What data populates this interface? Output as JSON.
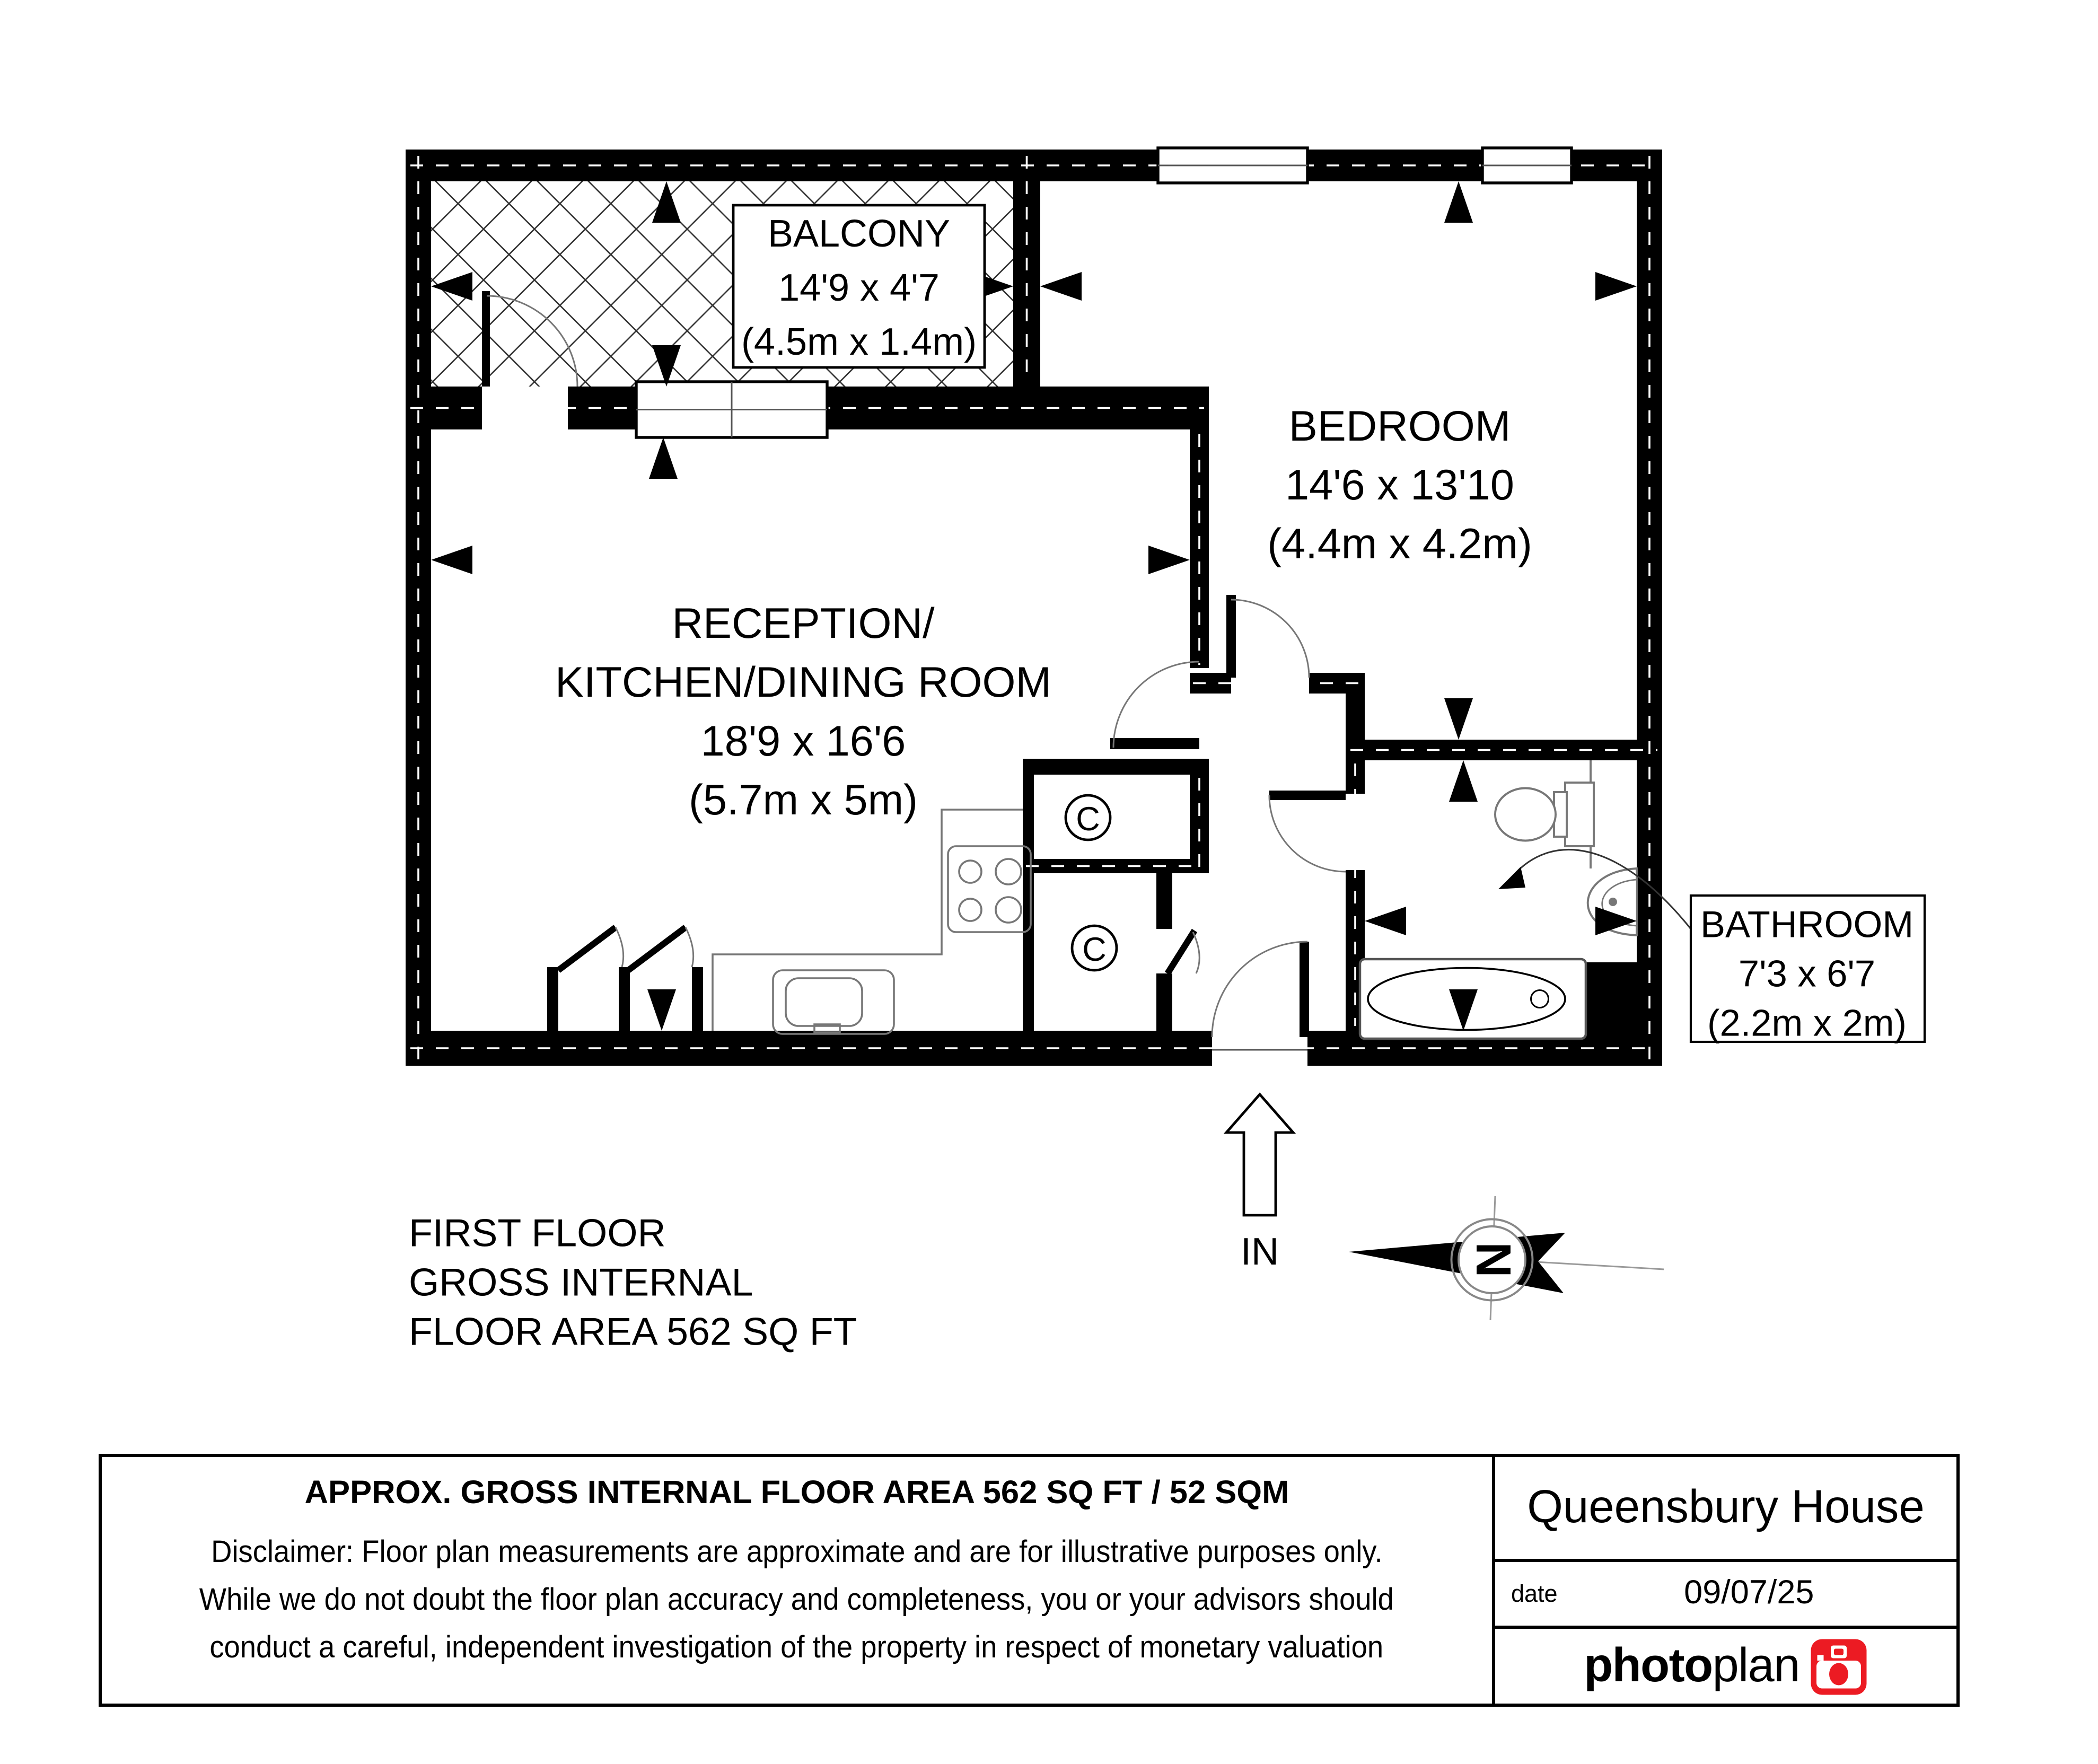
{
  "floor_plan": {
    "rooms": [
      {
        "name": "BALCONY",
        "dims": "14'9 x 4'7",
        "metric": "(4.5m x 1.4m)"
      },
      {
        "name": "BEDROOM",
        "dims": "14'6 x 13'10",
        "metric": "(4.4m x 4.2m)"
      },
      {
        "name_line1": "RECEPTION/",
        "name_line2": "KITCHEN/DINING ROOM",
        "dims": "18'9 x 16'6",
        "metric": "(5.7m x 5m)"
      },
      {
        "name": "BATHROOM",
        "dims": "7'3 x 6'7",
        "metric": "(2.2m x 2m)"
      }
    ],
    "labels": {
      "closet": "C",
      "entrance": "IN",
      "compass_north": "N"
    }
  },
  "floor_summary": {
    "line1": "FIRST FLOOR",
    "line2": "GROSS INTERNAL",
    "line3": "FLOOR AREA 562 SQ FT"
  },
  "footer": {
    "area_title": "APPROX. GROSS INTERNAL FLOOR AREA 562 SQ FT / 52 SQM",
    "disclaimer_line1": "Disclaimer: Floor plan measurements are approximate and are for illustrative purposes only.",
    "disclaimer_line2": "While we do not doubt the floor plan accuracy and completeness, you or your advisors should",
    "disclaimer_line3": "conduct a careful, independent investigation of the property in respect of monetary valuation",
    "property_name": "Queensbury House",
    "date_label": "date",
    "date_value": "09/07/25",
    "brand_bold": "photo",
    "brand_light": "plan",
    "brand_color": "#ec1b23"
  }
}
